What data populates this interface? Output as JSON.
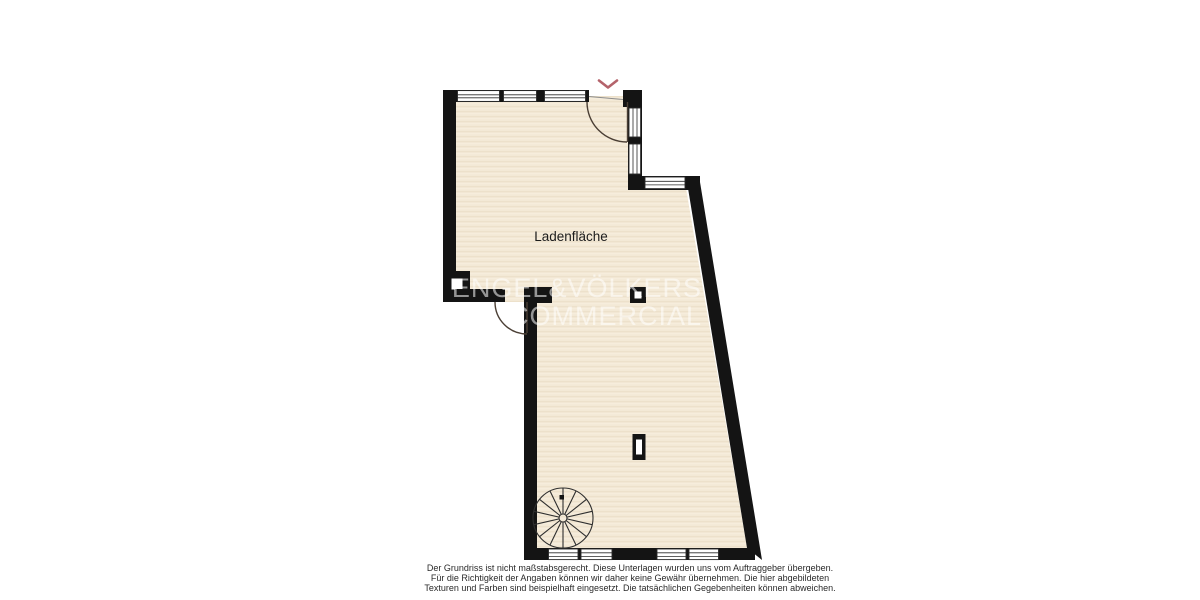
{
  "plan": {
    "room_label": "Ladenfläche"
  },
  "watermark": {
    "line1": "ENGEL&VÖLKERS",
    "line2": "COMMERCIAL"
  },
  "disclaimer": {
    "line1": "Der Grundriss ist nicht maßstabsgerecht. Diese Unterlagen wurden uns vom Auftraggeber übergeben.",
    "line2": "Für die Richtigkeit der Angaben können wir daher keine Gewähr übernehmen. Die hier abgebildeten",
    "line3": "Texturen und Farben sind beispielhaft eingesetzt. Die tatsächlichen Gegebenheiten können abweichen."
  },
  "colors": {
    "wall": "#141414",
    "floor": "#f3e9d6",
    "accent_red": "#b4636b",
    "door_line": "#4b3f35",
    "watermark_text": "rgba(255,255,255,0.55)"
  }
}
